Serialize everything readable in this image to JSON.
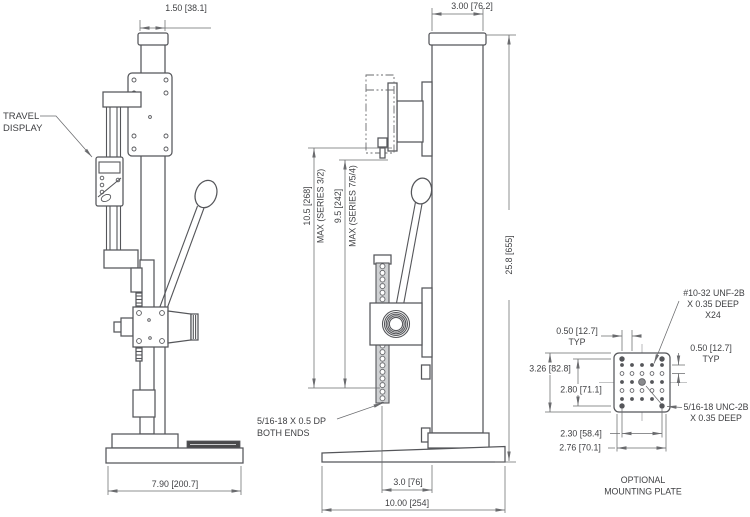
{
  "front_view": {
    "column_width_dim": "1.50 [38.1]",
    "travel_display_label": {
      "line1": "TRAVEL",
      "line2": "DISPLAY"
    },
    "base_width_dim": "7.90 [200.7]"
  },
  "side_view": {
    "column_depth_dim": "3.00 [76.2]",
    "overall_height_dim": "25.8 [655]",
    "travel_series_32": {
      "dim": "10.5 [268]",
      "note": "MAX (SERIES 3/2)"
    },
    "travel_series_754": {
      "dim": "9.5 [242]",
      "note": "MAX (SERIES 7/5/4)"
    },
    "rack_thread_note": {
      "line1": "5/16-18 X 0.5 DP",
      "line2": "BOTH ENDS"
    },
    "throat_depth_dim": "3.0 [76]",
    "base_depth_dim": "10.00 [254]"
  },
  "mounting_plate": {
    "caption": {
      "line1": "OPTIONAL",
      "line2": "MOUNTING PLATE"
    },
    "grid_tap_note": {
      "line1": "#10-32 UNF-2B",
      "line2": "X 0.35 DEEP",
      "line3": "X24"
    },
    "pitch_left": {
      "dim": "0.50 [12.7]",
      "typ": "TYP"
    },
    "pitch_right": {
      "dim": "0.50 [12.7]",
      "typ": "TYP"
    },
    "plate_height_dim": "3.26 [82.8]",
    "hole_rows_span_dim": "2.80 [71.1]",
    "corner_tap_note": {
      "line1": "5/16-18 UNC-2B",
      "line2": "X 0.35 DEEP"
    },
    "hole_cols_span_dim": "2.30 [58.4]",
    "outer_span_dim": "2.76 [70.1]"
  },
  "colors": {
    "object_line": "#55565a",
    "dimension_line": "#6a6b6e",
    "text": "#3e3f42",
    "background": "#ffffff",
    "base_label_plate": "#4a4a4c"
  }
}
